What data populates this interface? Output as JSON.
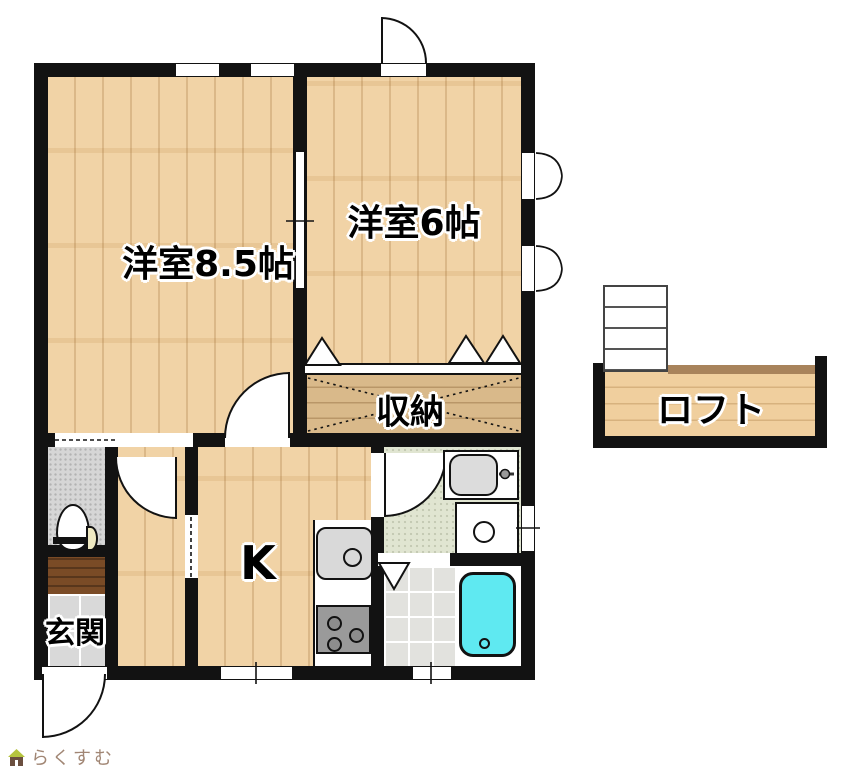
{
  "rooms": {
    "western85": "洋室8.5帖",
    "western6": "洋室6帖",
    "storage": "収納",
    "kitchen": "K",
    "entrance": "玄関",
    "loft": "ロフト"
  },
  "branding": {
    "logo": "らくすむ"
  },
  "icons": {
    "toilet": "toilet-icon",
    "kitchen_sink": "kitchen-sink-icon",
    "stove": "stove-icon",
    "wash_basin": "wash-basin-icon",
    "washing_machine": "washing-machine-icon",
    "bathtub": "bathtub-icon",
    "loft_ladder": "loft-ladder-icon",
    "house_logo": "house-logo-icon"
  },
  "colors": {
    "wall": "#121212",
    "wood-light": "#f0cf9e",
    "wood-storage": "#d9b98a",
    "step-brown": "#7a4b26",
    "loft-trim": "#a8835b",
    "washroom-floor": "#e0e5d1",
    "bathtub": "#5fe9f1",
    "fixture-gray": "#d9d9d9",
    "stove-gray": "#9a9a9a",
    "logo-text": "#a18674",
    "logo-roof": "#b5c43e",
    "logo-body": "#6b4f3f"
  }
}
